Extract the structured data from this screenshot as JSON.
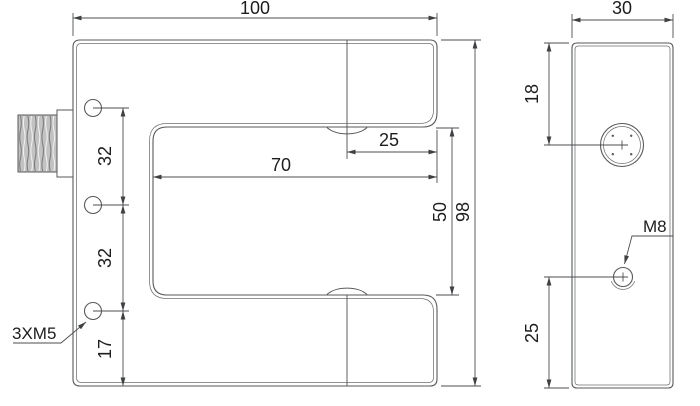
{
  "front_view": {
    "dim_overall_width": "100",
    "dim_overall_height": "98",
    "dim_slot_depth": "70",
    "dim_axis_to_opening": "25",
    "dim_slot_height": "50",
    "dim_hole_pitch_upper": "32",
    "dim_hole_pitch_lower": "32",
    "dim_hole_to_bottom": "17",
    "mount_holes_label": "3XM5"
  },
  "side_view": {
    "dim_depth": "30",
    "dim_lens_center_from_top": "18",
    "dim_hole_center_from_bottom": "25",
    "hole_label": "M8"
  },
  "colors": {
    "line": "#58595b",
    "dimension": "#4d4e50",
    "text": "#1d1d1f",
    "thread_fill": "#c2c2c2",
    "background": "#ffffff"
  }
}
